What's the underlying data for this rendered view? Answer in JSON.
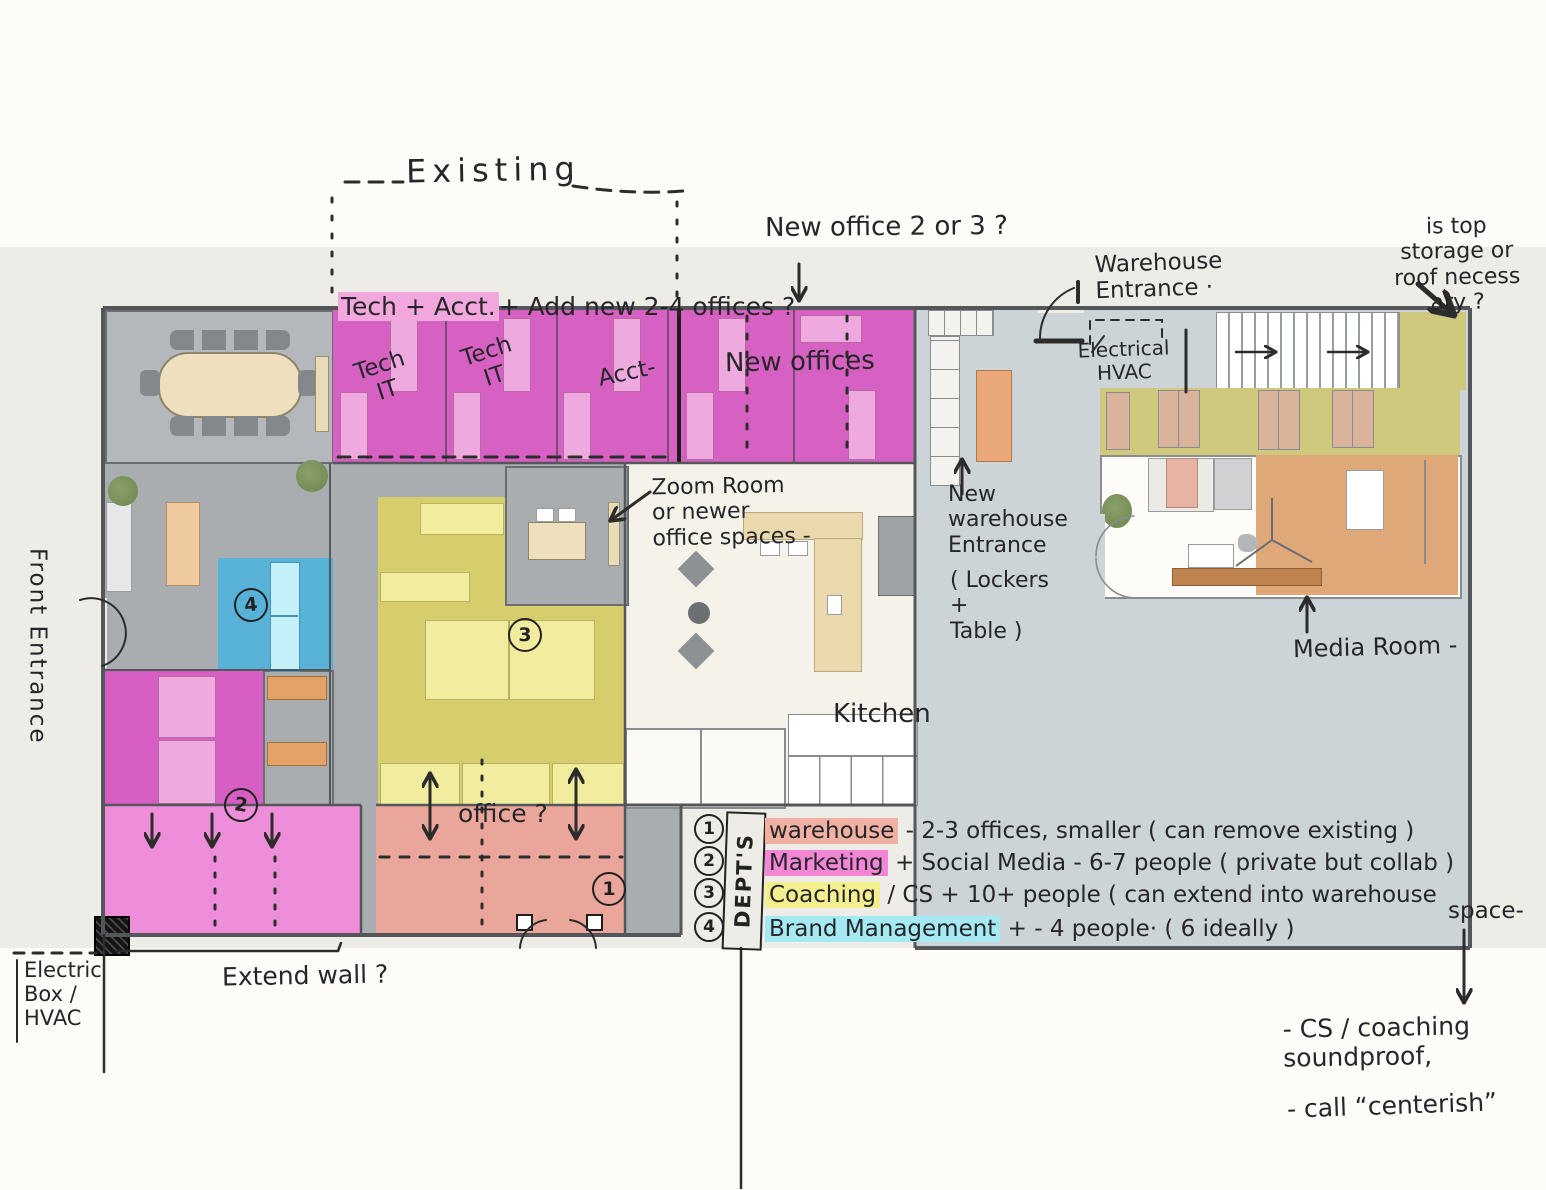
{
  "colors": {
    "marketing_pink": "#d761c2",
    "bottom_pink": "#ee8dda",
    "warehouse_salmon": "#eba69c",
    "coaching_yellow": "#d6cd6d",
    "brand_blue": "#4fb2dd",
    "warehouse_floor": "#cdd4d8",
    "storage_khaki": "#cfc97d",
    "ink": "#2c2c2c"
  },
  "plan": {
    "rooms": {
      "tech_it_1": "Tech\nIT",
      "tech_it_2": "Tech\nIT",
      "acct": "Acct-",
      "new_offices": "New  offices",
      "kitchen": "Kitchen"
    },
    "markers": {
      "m1": "1",
      "m2": "2",
      "m3": "3",
      "m4": "4"
    }
  },
  "annotations": {
    "existing": "Existing",
    "tech_acct": "Tech + Acct.",
    "add_new": "+ Add new  2-4 offices ?",
    "new_office": "New office  2 or 3 ?",
    "warehouse_entrance": "Warehouse\nEntrance ·",
    "top_storage": "is top\nstorage or\nroof   necess\nary ?",
    "electrical": "Electrical\nHVAC",
    "zoom_room": "Zoom Room\nor newer\n   office spaces -",
    "new_warehouse": "New\nwarehouse\nEntrance",
    "lockers": "( Lockers\n        +\n    Table  )",
    "media_room": "Media Room -",
    "office_q": "office ?",
    "front_entrance": "Front Entrance",
    "electric_box": "Electric\nBox /\nHVAC",
    "extend_wall": "Extend wall ?",
    "space_note": "space-",
    "cs_note": "-   CS / coaching\n        soundproof,",
    "call_note": "-   call “centerish”"
  },
  "legend": {
    "title": "DEPT'S",
    "items": [
      {
        "num": "1",
        "name": "warehouse",
        "desc": " -  2-3 offices, smaller ( can remove existing )",
        "highlight": "#f0b0a2"
      },
      {
        "num": "2",
        "name": "Marketing",
        "desc": " + Social Media -   6-7 people ( private but collab )",
        "highlight": "#f387d5"
      },
      {
        "num": "3",
        "name": "Coaching",
        "desc": " / CS   +   10+ people ( can extend into warehouse",
        "highlight": "#f3ee8e"
      },
      {
        "num": "4",
        "name": "Brand Management",
        "desc": " + -   4 people· ( 6 ideally )",
        "highlight": "#a5e9f3"
      }
    ]
  }
}
